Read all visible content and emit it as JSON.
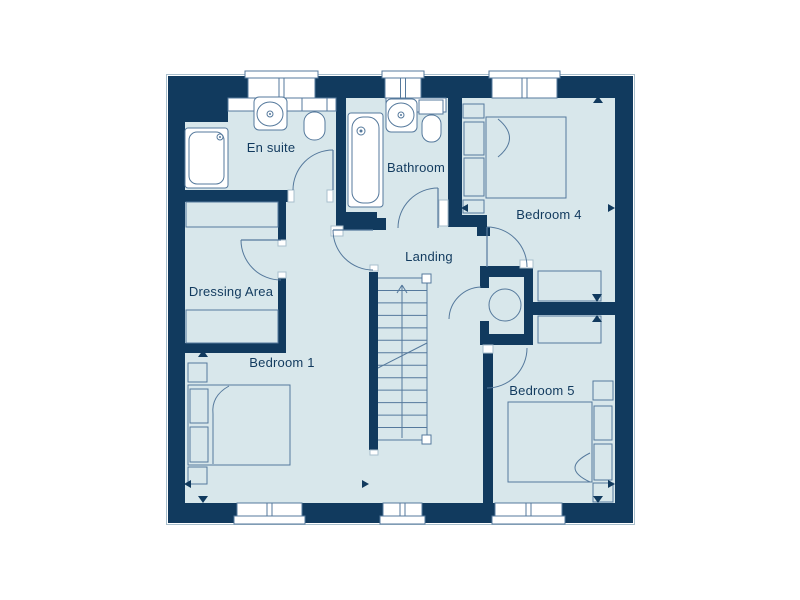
{
  "colors": {
    "wall": "#113a5e",
    "floor": "#d8e7eb",
    "line": "#55799c",
    "white": "#ffffff",
    "outline_light": "#a9bfcc",
    "text": "#113a5e"
  },
  "canvas": {
    "width": 800,
    "height": 600
  },
  "rooms": [
    {
      "id": "en-suite",
      "label": "En suite",
      "x": 271,
      "y": 152
    },
    {
      "id": "bathroom",
      "label": "Bathroom",
      "x": 416,
      "y": 172
    },
    {
      "id": "bedroom-4",
      "label": "Bedroom 4",
      "x": 549,
      "y": 219
    },
    {
      "id": "landing",
      "label": "Landing",
      "x": 429,
      "y": 261
    },
    {
      "id": "dressing-area",
      "label": "Dressing Area",
      "x": 231,
      "y": 296
    },
    {
      "id": "bedroom-1",
      "label": "Bedroom 1",
      "x": 282,
      "y": 367
    },
    {
      "id": "bedroom-5",
      "label": "Bedroom 5",
      "x": 542,
      "y": 395
    }
  ],
  "geometry": {
    "outline": [
      166.5,
      74.5,
      468,
      450
    ],
    "floor": [
      184,
      98,
      431,
      405
    ],
    "walls": [
      [
        168,
        76,
        465,
        22
      ],
      [
        168,
        503,
        465,
        20
      ],
      [
        168,
        76,
        17,
        447
      ],
      [
        615,
        76,
        18,
        447
      ],
      [
        168,
        98,
        60,
        24
      ],
      [
        336,
        76,
        10,
        154
      ],
      [
        168,
        190,
        120,
        12
      ],
      [
        278,
        202,
        8,
        38
      ],
      [
        278,
        278,
        8,
        65
      ],
      [
        168,
        343,
        118,
        10
      ],
      [
        336,
        212,
        41,
        15
      ],
      [
        369,
        272,
        9,
        178
      ],
      [
        346,
        218,
        40,
        12
      ],
      [
        448,
        98,
        14,
        124
      ],
      [
        448,
        215,
        39,
        12
      ],
      [
        477,
        227,
        13,
        9
      ],
      [
        480,
        266,
        53,
        11
      ],
      [
        524,
        266,
        9,
        79
      ],
      [
        480,
        334,
        53,
        11
      ],
      [
        480,
        266,
        9,
        22
      ],
      [
        480,
        321,
        9,
        24
      ],
      [
        533,
        302,
        82,
        13
      ],
      [
        483,
        353,
        10,
        150
      ]
    ],
    "jambs": [
      [
        288,
        190,
        6,
        12
      ],
      [
        327,
        190,
        6,
        12
      ],
      [
        278,
        240,
        8,
        6
      ],
      [
        278,
        272,
        8,
        6
      ],
      [
        331,
        226,
        12,
        10
      ],
      [
        439,
        200,
        9,
        26
      ],
      [
        520,
        260,
        13,
        8
      ],
      [
        483,
        345,
        10,
        8
      ],
      [
        370,
        450,
        8,
        5
      ],
      [
        370,
        265,
        8,
        6
      ]
    ],
    "windows_top": [
      [
        248,
        67
      ],
      [
        385,
        36
      ],
      [
        492,
        65
      ]
    ],
    "windows_bottom": [
      [
        237,
        65
      ],
      [
        383,
        39
      ],
      [
        495,
        67
      ]
    ],
    "doors": [
      {
        "name": "en-suite-door",
        "leaf": [
          333,
          190,
          333,
          150
        ],
        "arc": "M293,190 A40,40 0 0 1 333,150"
      },
      {
        "name": "dressing-area-door",
        "leaf": [
          281,
          240,
          241,
          240
        ],
        "arc": "M241,240 A40,40 0 0 0 281,280"
      },
      {
        "name": "bedroom-1-door",
        "leaf": [
          373,
          230,
          333,
          230
        ],
        "arc": "M333,230 A40,40 0 0 0 373,270"
      },
      {
        "name": "bathroom-door",
        "leaf": [
          438,
          228,
          438,
          188
        ],
        "arc": "M398,228 A40,40 0 0 1 438,188"
      },
      {
        "name": "bedroom-4-door",
        "leaf": [
          487,
          267,
          487,
          227
        ],
        "arc": "M487,227 A40,40 0 0 1 527,267"
      },
      {
        "name": "cupboard-door",
        "leaf": null,
        "arc": "M481,287 A33,33 0 0 0 449,319"
      },
      {
        "name": "bedroom-5-door",
        "leaf": null,
        "arc": "M527,348 A40,40 0 0 1 487,388"
      }
    ],
    "stairs": {
      "x1": 378,
      "y1": 278,
      "x2": 427,
      "y2": 440,
      "steps": 13,
      "center_x": 402,
      "arrow_tip": [
        402,
        285
      ],
      "arrow_wings": [
        [
          397,
          293
        ],
        [
          407,
          293
        ]
      ],
      "break_line": [
        378,
        368,
        427,
        343
      ],
      "newels": [
        [
          422,
          274,
          9,
          9
        ],
        [
          422,
          435,
          9,
          9
        ]
      ]
    },
    "fixtures": [
      {
        "name": "shower",
        "shapes": [
          {
            "t": "rect",
            "v": [
              185,
              128,
              43,
              60
            ],
            "rx": 3,
            "f": "white"
          },
          {
            "t": "rect",
            "v": [
              189,
              132,
              35,
              52
            ],
            "rx": 8,
            "f": "none"
          },
          {
            "t": "circle",
            "v": [
              220,
              137,
              3
            ]
          },
          {
            "t": "dot",
            "v": [
              220,
              137,
              1
            ]
          }
        ]
      },
      {
        "name": "en-suite-vanity",
        "shapes": [
          {
            "t": "rect",
            "v": [
              228,
              98,
              108,
              13
            ],
            "f": "white"
          },
          {
            "t": "rect",
            "v": [
              254,
              97,
              33,
              33
            ],
            "rx": 5,
            "f": "white"
          },
          {
            "t": "ellipse",
            "v": [
              270,
              114,
              13,
              12
            ]
          },
          {
            "t": "circle",
            "v": [
              270,
              114,
              3
            ]
          },
          {
            "t": "dot",
            "v": [
              270,
              114,
              1
            ]
          }
        ]
      },
      {
        "name": "en-suite-toilet",
        "shapes": [
          {
            "t": "rect",
            "v": [
              302,
              98,
              25,
              13
            ],
            "f": "white"
          },
          {
            "t": "rect",
            "v": [
              304,
              112,
              21,
              28
            ],
            "rx": 10,
            "f": "white"
          }
        ]
      },
      {
        "name": "bath",
        "shapes": [
          {
            "t": "rect",
            "v": [
              348,
              113,
              35,
              94
            ],
            "rx": 3,
            "f": "white"
          },
          {
            "t": "rect",
            "v": [
              352,
              117,
              27,
              86
            ],
            "rx": 11,
            "f": "none"
          },
          {
            "t": "circle",
            "v": [
              361,
              131,
              4
            ]
          },
          {
            "t": "dot",
            "v": [
              361,
              131,
              1.5
            ]
          }
        ]
      },
      {
        "name": "bathroom-vanity",
        "shapes": [
          {
            "t": "rect",
            "v": [
              386,
              98,
              60,
              14
            ],
            "f": "white"
          },
          {
            "t": "rect",
            "v": [
              386,
              99,
              31,
              33
            ],
            "rx": 5,
            "f": "white"
          },
          {
            "t": "ellipse",
            "v": [
              401,
              115,
              13,
              12
            ]
          },
          {
            "t": "circle",
            "v": [
              401,
              115,
              3
            ]
          },
          {
            "t": "dot",
            "v": [
              401,
              115,
              1
            ]
          }
        ]
      },
      {
        "name": "bathroom-toilet",
        "shapes": [
          {
            "t": "rect",
            "v": [
              419,
              100,
              24,
              14
            ],
            "f": "white"
          },
          {
            "t": "rect",
            "v": [
              422,
              115,
              19,
              27
            ],
            "rx": 9,
            "f": "white"
          }
        ]
      },
      {
        "name": "hot-water-cylinder",
        "shapes": [
          {
            "t": "circle",
            "v": [
              505,
              305,
              16
            ]
          }
        ]
      },
      {
        "name": "dressing-wardrobe-top",
        "shapes": [
          {
            "t": "rect",
            "v": [
              186,
              202,
              92,
              25
            ],
            "f": "none"
          }
        ]
      },
      {
        "name": "dressing-wardrobe-bottom",
        "shapes": [
          {
            "t": "rect",
            "v": [
              186,
              310,
              92,
              33
            ],
            "f": "none"
          }
        ]
      },
      {
        "name": "bedroom-4-wardrobe",
        "shapes": [
          {
            "t": "rect",
            "v": [
              538,
              271,
              63,
              30
            ],
            "f": "none"
          }
        ]
      },
      {
        "name": "bedroom-5-wardrobe",
        "shapes": [
          {
            "t": "rect",
            "v": [
              538,
              316,
              63,
              27
            ],
            "f": "none"
          }
        ]
      },
      {
        "name": "bed-1",
        "shapes": [
          {
            "t": "rect",
            "v": [
              188,
              385,
              102,
              80
            ],
            "f": "none"
          },
          {
            "t": "rect",
            "v": [
              190,
              389,
              18,
              34
            ],
            "f": "none"
          },
          {
            "t": "rect",
            "v": [
              190,
              427,
              18,
              35
            ],
            "f": "none"
          },
          {
            "t": "path",
            "d": "M229,386 Q211,396 213,414 L213,464"
          },
          {
            "t": "rect",
            "v": [
              188,
              363,
              19,
              19
            ],
            "f": "none"
          },
          {
            "t": "rect",
            "v": [
              188,
              467,
              19,
              17
            ],
            "f": "none"
          }
        ]
      },
      {
        "name": "bed-4",
        "shapes": [
          {
            "t": "rect",
            "v": [
              486,
              117,
              80,
              81
            ],
            "f": "none"
          },
          {
            "t": "rect",
            "v": [
              464,
              122,
              20,
              33
            ],
            "f": "none"
          },
          {
            "t": "rect",
            "v": [
              464,
              158,
              20,
              38
            ],
            "f": "none"
          },
          {
            "t": "path",
            "d": "M498,119 Q521,138 498,157"
          },
          {
            "t": "rect",
            "v": [
              463,
              104,
              21,
              14
            ],
            "f": "none"
          },
          {
            "t": "rect",
            "v": [
              463,
              200,
              21,
              13
            ],
            "f": "none"
          }
        ]
      },
      {
        "name": "bed-5",
        "shapes": [
          {
            "t": "rect",
            "v": [
              508,
              402,
              84,
              80
            ],
            "f": "none"
          },
          {
            "t": "rect",
            "v": [
              594,
              406,
              18,
              34
            ],
            "f": "none"
          },
          {
            "t": "rect",
            "v": [
              594,
              444,
              18,
              36
            ],
            "f": "none"
          },
          {
            "t": "path",
            "d": "M590,453 Q560,468 590,482"
          },
          {
            "t": "rect",
            "v": [
              593,
              381,
              20,
              19
            ],
            "f": "none"
          },
          {
            "t": "rect",
            "v": [
              593,
              483,
              20,
              19
            ],
            "f": "none"
          }
        ]
      }
    ],
    "markers": [
      {
        "name": "dim-arrow-up-bedroom4",
        "pts": "593,103 603,103 598,96"
      },
      {
        "name": "dim-arrow-left-bedroom4",
        "pts": "468,204 468,212 461,208"
      },
      {
        "name": "dim-arrow-right-bedroom4",
        "pts": "608,204 608,212 615,208"
      },
      {
        "name": "dim-arrow-down-divider",
        "pts": "592,294 602,294 597,302"
      },
      {
        "name": "dim-arrow-up-divider",
        "pts": "592,322 602,322 597,315"
      },
      {
        "name": "dim-arrow-up-bedroom1",
        "pts": "198,357 208,357 203,350"
      },
      {
        "name": "dim-arrow-left-bedroom1",
        "pts": "191,480 191,488 184,484"
      },
      {
        "name": "dim-arrow-right-bedroom1",
        "pts": "362,480 362,488 369,484"
      },
      {
        "name": "dim-arrow-down-bedroom1",
        "pts": "198,496 208,496 203,503"
      },
      {
        "name": "dim-arrow-left-bedroom5",
        "pts": "490,481 490,489 483,485"
      },
      {
        "name": "dim-arrow-right-bedroom5",
        "pts": "608,480 608,488 615,484"
      },
      {
        "name": "dim-arrow-down-bedroom5",
        "pts": "593,496 603,496 598,503"
      }
    ]
  }
}
